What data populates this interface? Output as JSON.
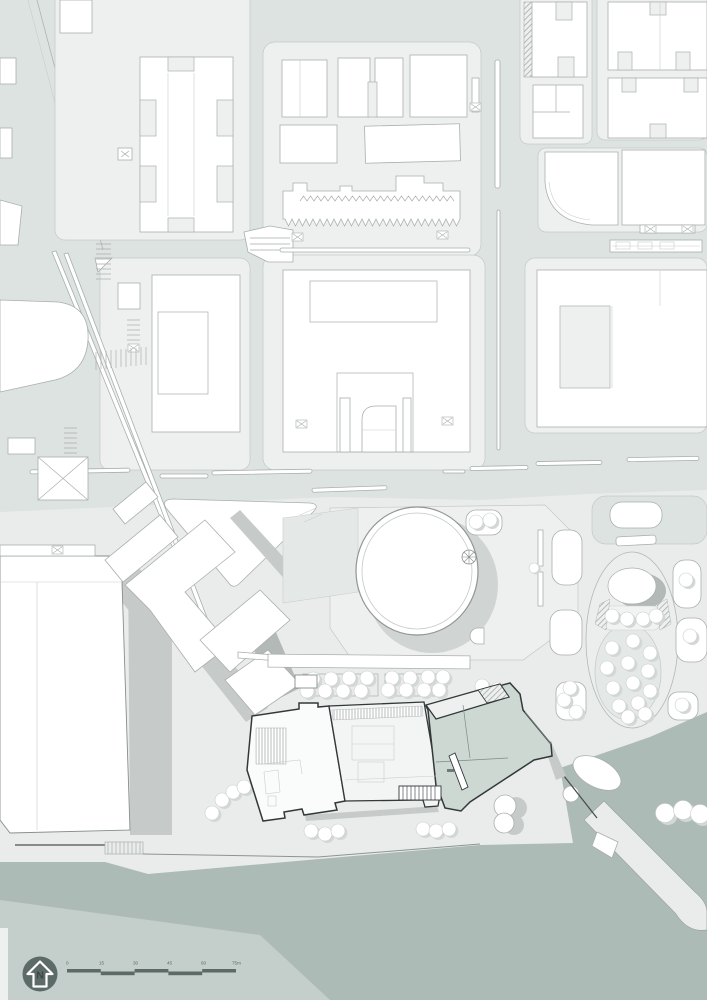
{
  "plan": {
    "type": "architectural-site-plan",
    "highlight": "project-building-at-waterfront"
  },
  "legend": {
    "north_arrow": {
      "label": "N"
    },
    "scale_bar": {
      "labels": [
        "0",
        "15",
        "30",
        "45",
        "60",
        "75m"
      ],
      "unit": "m"
    }
  },
  "colors": {
    "road": "#dde3e1",
    "block": "#eef0ef",
    "building": "#ffffff",
    "outline": "#a9afae",
    "outline_dark": "#878e8d",
    "curb": "#c3c9c7",
    "faint": "#c9cecd",
    "plaza": "#e9eceb",
    "water": "#adbbb7",
    "margin_light": "#c4ceca",
    "shadow": "#c6cbca",
    "shadow_dark": "#b2b9b7",
    "hero_outline": "#33383a",
    "hero_teal": "#cdd8d3",
    "tree_shadow": "#d3d8d5",
    "quay_dark": "#4a504f",
    "ink": "#5d6b68"
  }
}
